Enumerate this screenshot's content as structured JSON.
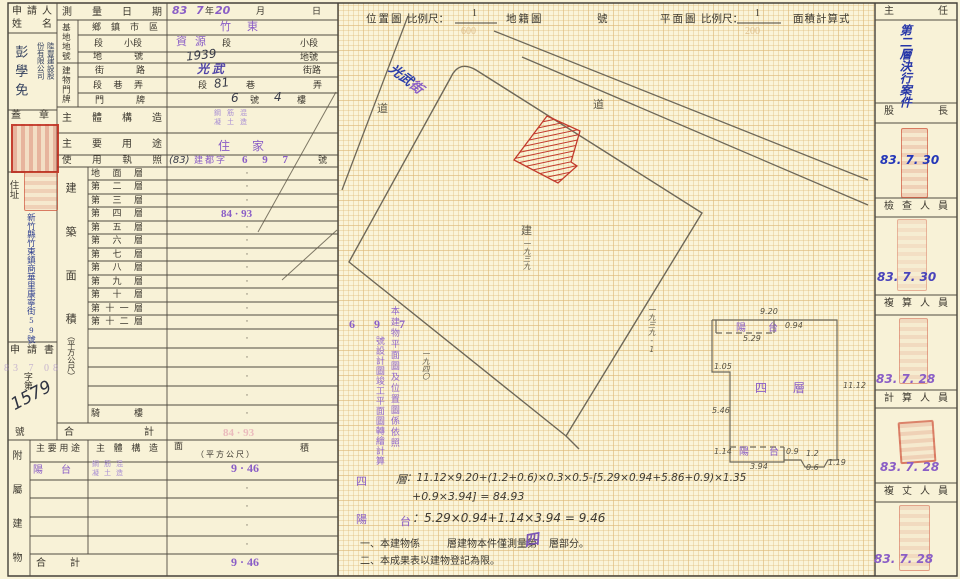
{
  "applicant": {
    "header_line1": "申請人",
    "header_line2": "姓名",
    "name": "彭學免",
    "company_col1": "陸豐建設股",
    "company_col2": "份有限公司",
    "seal_label": "蓋章",
    "residence_label": "住址",
    "residence_seal": "",
    "address": "新竹縣竹東鎮商華里康寧街59號",
    "application_label": "申請書",
    "faint_date": "83 7 08",
    "file_prefix": "字第",
    "file_no": "1579",
    "file_suffix": "號"
  },
  "survey": {
    "label": "測量日期",
    "v1": "83",
    "v2": "7",
    "u1": "年",
    "v3": "20",
    "u2": "月",
    "u3": "日"
  },
  "site": {
    "group": "基地地號",
    "r1_label": "鄉鎮市區",
    "r1_value": "竹東",
    "r2_label1": "段",
    "r2_label2": "小段",
    "r2_value": "資源",
    "r2_unit1": "段",
    "r2_unit2": "小段",
    "r3_label": "地號",
    "r3_value": "1939",
    "r3_unit": "地號"
  },
  "plate": {
    "group": "建物門牌",
    "street_label": "街路",
    "street_value": "光武",
    "street_unit": "街路",
    "lane_label": "段巷弄",
    "lane_u1": "段",
    "lane_value": "81",
    "lane_u2": "巷",
    "lane_u3": "弄",
    "door_label": "門牌",
    "door_v1": "6",
    "door_u1": "號",
    "door_v2": "4",
    "door_u2": "樓"
  },
  "structure": {
    "label": "主體構造",
    "stamp_l1": "鋼筋混",
    "stamp_l2": "凝土造"
  },
  "usage": {
    "label": "主要用途",
    "value": "住家"
  },
  "license": {
    "label": "使用執照",
    "pre": "(83)",
    "mid": "建都字",
    "num": "6 9 7",
    "suffix": "號"
  },
  "floors": {
    "group": "建築面積",
    "group_unit": "（平方公尺）",
    "rows": [
      {
        "label": "地面層",
        "value": "·"
      },
      {
        "label": "第二層",
        "value": "·"
      },
      {
        "label": "第三層",
        "value": "·"
      },
      {
        "label": "第四層",
        "value": "84 · 93"
      },
      {
        "label": "第五層",
        "value": "·"
      },
      {
        "label": "第六層",
        "value": "·"
      },
      {
        "label": "第七層",
        "value": "·"
      },
      {
        "label": "第八層",
        "value": "·"
      },
      {
        "label": "第九層",
        "value": "·"
      },
      {
        "label": "第十層",
        "value": "·"
      },
      {
        "label": "第十一層",
        "value": "·"
      },
      {
        "label": "第十二層",
        "value": "·"
      },
      {
        "label": "",
        "value": "·"
      },
      {
        "label": "",
        "value": "·"
      },
      {
        "label": "",
        "value": "·"
      },
      {
        "label": "",
        "value": "·"
      },
      {
        "label": "騎樓",
        "value": "·"
      }
    ],
    "total_label": "合計",
    "total_value": "84 · 93"
  },
  "annex": {
    "group": "附屬建物",
    "h_use": "主要用途",
    "h_struct": "主體構造",
    "h_area_l": "面",
    "h_area_r": "積",
    "h_area_sub": "（ 平 方 公 尺 ）",
    "row1": {
      "use": "陽台",
      "struct_l1": "鋼筋混",
      "struct_l2": "凝土造",
      "area": "9 · 46"
    },
    "blank_dot": "·",
    "total_label": "合計",
    "total_value": "9 · 46"
  },
  "plan": {
    "hdr": {
      "loc": "位置圖",
      "scale1": "比例尺：",
      "num1": "1",
      "den1": "600",
      "cad": "地籍圖",
      "no": "號",
      "floor": "平面圖",
      "scale2": "比例尺：",
      "num2": "1",
      "den2": "200",
      "calc": "面積計算式"
    },
    "labels": {
      "road_left": "道",
      "road_right": "道",
      "street_blue": "光武",
      "street_purple": "街",
      "lot_build": "建",
      "lot_main": "一九三九",
      "lot_left": "一九四〇",
      "lot_right": "一九三九-1",
      "note_697": "6 9 7",
      "note_col_a": "本建物平面圖及位置圖係依照",
      "note_col_b": "號設計圖竣工平面圖轉繪計算"
    },
    "detail": {
      "floor": "四層",
      "balcony_top": "陽台",
      "balcony_bottom": "陽台",
      "d_920": "9.20",
      "d_094": "0.94",
      "d_529": "5.29",
      "d_105": "1.05",
      "d_1112": "11.12",
      "d_546": "5.46",
      "d_114": "1.14",
      "d_394": "3.94",
      "d_09": "0.9",
      "d_12": "1.2",
      "d_06": "0.6",
      "d_119": "1.19"
    },
    "f1_label": "四",
    "f1_label2": "層",
    "f1a": "：11.12×9.20+(1.2+0.6)×0.3×0.5-[5.29×0.94+5.86+0.9)×1.35",
    "f1b": "+0.9×3.94] = 84.93",
    "f2_label": "陽",
    "f2_label2": "台",
    "f2": "：5.29×0.94+1.14×3.94 = 9.46",
    "note1a": "一、本建物係",
    "note1b": "層建物本件僅測量第",
    "note1_hand": "四",
    "note1c": "層部分。",
    "note2": "二、本成果表以建物登記為限。"
  },
  "approvals": {
    "boxes": [
      {
        "title": "主任",
        "note": "第二層決行案件",
        "date": ""
      },
      {
        "title": "股長",
        "date": "83. 7. 30"
      },
      {
        "title": "檢查人員",
        "date": "83. 7. 30"
      },
      {
        "title": "複算人員",
        "date": "83. 7. 28"
      },
      {
        "title": "計算人員",
        "date": "83. 7. 28"
      },
      {
        "title": "複丈人員",
        "date": "83. 7. 28"
      }
    ]
  }
}
